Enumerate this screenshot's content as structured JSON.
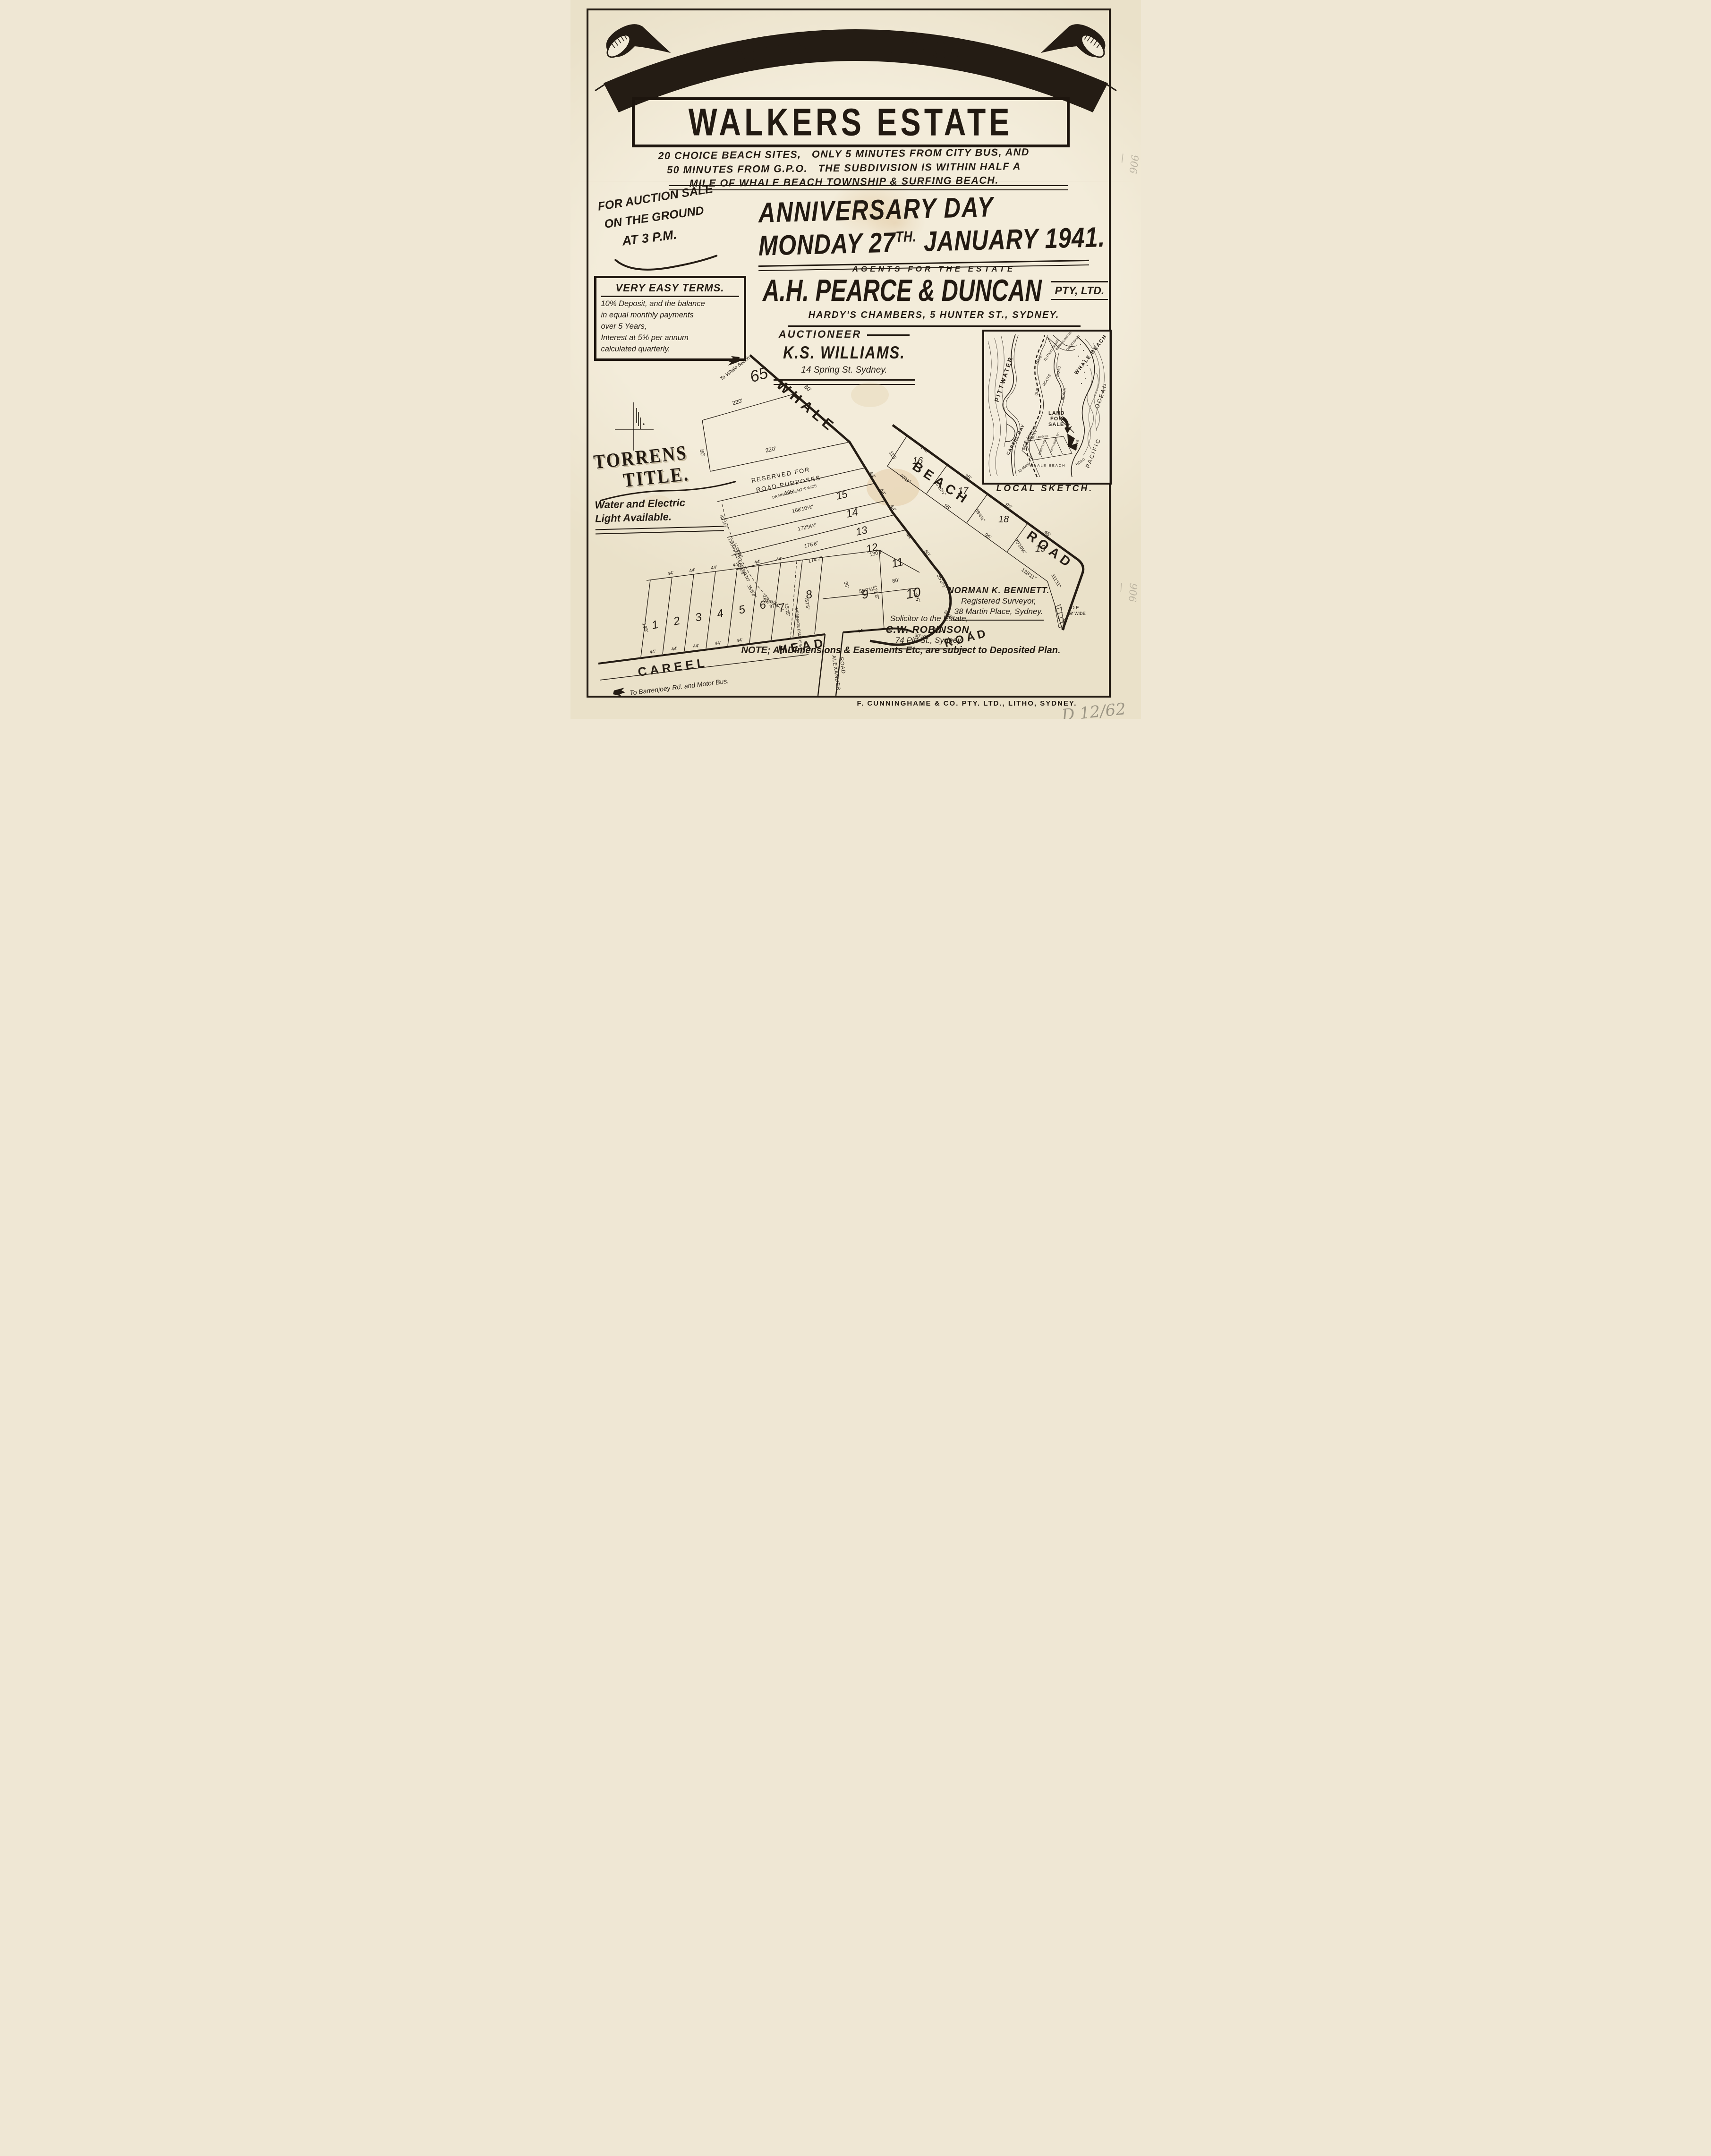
{
  "banner": {
    "title": "WHALE BEACH",
    "subtitle": "WALKERS ESTATE"
  },
  "intro": {
    "line1": "20 CHOICE BEACH SITES,   ONLY 5 MINUTES FROM CITY BUS, AND",
    "line2": "50 MINUTES FROM G.P.O.   THE SUBDIVISION IS WITHIN HALF A",
    "line3": "MILE OF WHALE BEACH TOWNSHIP & SURFING BEACH."
  },
  "auction": {
    "line1": "FOR AUCTION SALE",
    "line2": "ON THE GROUND",
    "line3": "AT 3 P.M."
  },
  "event": {
    "title": "ANNIVERSARY DAY",
    "date_main": "MONDAY 27",
    "date_sup": "TH.",
    "date_rest": " JANUARY 1941."
  },
  "agents": {
    "heading": "AGENTS FOR THE ESTATE",
    "name": "A.H. PEARCE & DUNCAN",
    "suffix": "PTY, LTD.",
    "address": "HARDY'S CHAMBERS, 5 HUNTER ST., SYDNEY."
  },
  "terms": {
    "title": "VERY EASY TERMS.",
    "lines": [
      "10% Deposit, and the balance",
      "in equal monthly payments",
      "over 5 Years,",
      "Interest at 5% per annum",
      "calculated quarterly."
    ]
  },
  "auctioneer": {
    "heading": "AUCTIONEER",
    "name": "K.S. WILLIAMS.",
    "address": "14 Spring St. Sydney."
  },
  "torrens": {
    "line1": "TORRENS",
    "line2": "TITLE.",
    "utilities1": "Water and Electric",
    "utilities2": "Light Available."
  },
  "surveyor": {
    "name": "NORMAN K. BENNETT.",
    "line2": "Registered Surveyor,",
    "line3": "38 Martin Place, Sydney."
  },
  "solicitor": {
    "line1": "Solicitor to the Estate,",
    "name": "C.W. ROBINSON.",
    "line3": "74 Pitt St., Sydney."
  },
  "note": "NOTE; All Dimensions & Easements Etc, are subject to Deposited Plan.",
  "printer": "F. CUNNINGHAME & CO. PTY. LTD., LITHO, SYDNEY.",
  "annotations": {
    "side1": "906—",
    "side2": "906—",
    "corner": "D 12/62"
  },
  "plan": {
    "labels": {
      "to_whale": "To Whale Beach",
      "whale": "WHALE",
      "beach": "BEACH",
      "road": "ROAD",
      "careel": "CAREEL",
      "head": "HEAD",
      "road2": "ROAD",
      "alexander": "ALEXANDER",
      "alex_road": "ROAD",
      "barrenjoey": "To Barrenjoey Rd. and Motor Bus.",
      "res1": "RESERVED FOR",
      "res2": "ROAD PURPOSES",
      "n1": "1",
      "n2": "2",
      "n3": "3",
      "n4": "4",
      "n5": "5",
      "n6": "6",
      "n7": "7",
      "n8": "8",
      "n9": "9",
      "n10": "10",
      "n11": "11",
      "n12": "12",
      "n13": "13",
      "n14": "14",
      "n15": "15",
      "n16": "16",
      "n17": "17",
      "n18": "18",
      "n19": "19",
      "n65": "65",
      "d65_top": "220'",
      "d65_bot": "220'",
      "d65_l": "80'",
      "d65_r": "80'",
      "drain1a": "DRAINAGE EASEMENT",
      "drain1b": "6' WIDE",
      "drain2": "DRAINAGE ESMT 6' WIDE",
      "drain3": "DRAINAGE ESMT 6' WIDE",
      "d43a": "43'1½\"",
      "d43b": "43'1½\"",
      "d35": "35'5½\"",
      "d106": "10'6¾\"",
      "d37": "37'9\"",
      "len15": "165'",
      "w15": "44'",
      "len14": "168'10½\"",
      "w14": "44'",
      "len13": "172'9¼\"",
      "w13": "44'",
      "len12": "176'8\"",
      "w12": "44'",
      "len11": "174'7\"",
      "len11b": "130'7\"",
      "w11": "50'",
      "d80": "80'",
      "d36": "36'",
      "d59": "59'7¾\"",
      "d55a": "55'2½\"",
      "d108": "108'5\"",
      "d38": "38'2¼\"",
      "d40": "40'3\"",
      "d30": "30'10\"",
      "d55b": "55'",
      "d121": "121'5\"",
      "d157a": "157'5\"",
      "d157b": "157'5\"",
      "len1": "165'",
      "len6": "165'",
      "t44a": "44'",
      "t44b": "44'",
      "t44c": "44'",
      "t44d": "44'",
      "t44e": "44'",
      "t44f": "44'",
      "b44a": "44'",
      "b44b": "44'",
      "b44c": "44'",
      "b44d": "44'",
      "b44e": "44'",
      "b44f": "44'",
      "d16a": "140'",
      "d16b": "115'",
      "d16c": "40'11\"",
      "d16d": "65'10½\"",
      "d17a": "95'",
      "d17b": "95'",
      "d17c": "68'4½\"",
      "d18a": "95'",
      "d18b": "95'",
      "d18c": "70'10¼\"",
      "d19a": "45'",
      "d19b": "128'11\"",
      "d19c": "111'11\"",
      "de1": "D.E",
      "de2": "6' WIDE"
    }
  },
  "sketch": {
    "labels": {
      "pittwater": "PITTWATER",
      "careel_bay": "CAREEL BAY",
      "road": "ROAD",
      "to_palm": "To Palm Beach",
      "bus": "BUS",
      "route": "ROUTE",
      "barrenjoey": "BARRENJOEY",
      "motor": "MOTOR",
      "to_manly": "To Manly",
      "whale_beach": "WHALE BEACH",
      "ocean": "OCEAN",
      "pacific": "PACIFIC",
      "beach": "BEACH",
      "road2": "ROAD",
      "strand": "THE STRAND",
      "bungalow": "BUNGALOW RD",
      "land1": "LAND",
      "land2": "FOR",
      "land3": "SALE",
      "careel_head": "CAREEL HEAD RD",
      "albert": "ALBERT RD",
      "alexander": "ALEXANDER RD",
      "wb2": "WHALE BEACH",
      "road3": "ROAD",
      "whale2": "WHALE"
    },
    "caption": "LOCAL SKETCH."
  },
  "colors": {
    "paper": "#f1ead7",
    "ink": "#221a12",
    "stain": "#d8b98c",
    "pencil": "#8f897a"
  }
}
